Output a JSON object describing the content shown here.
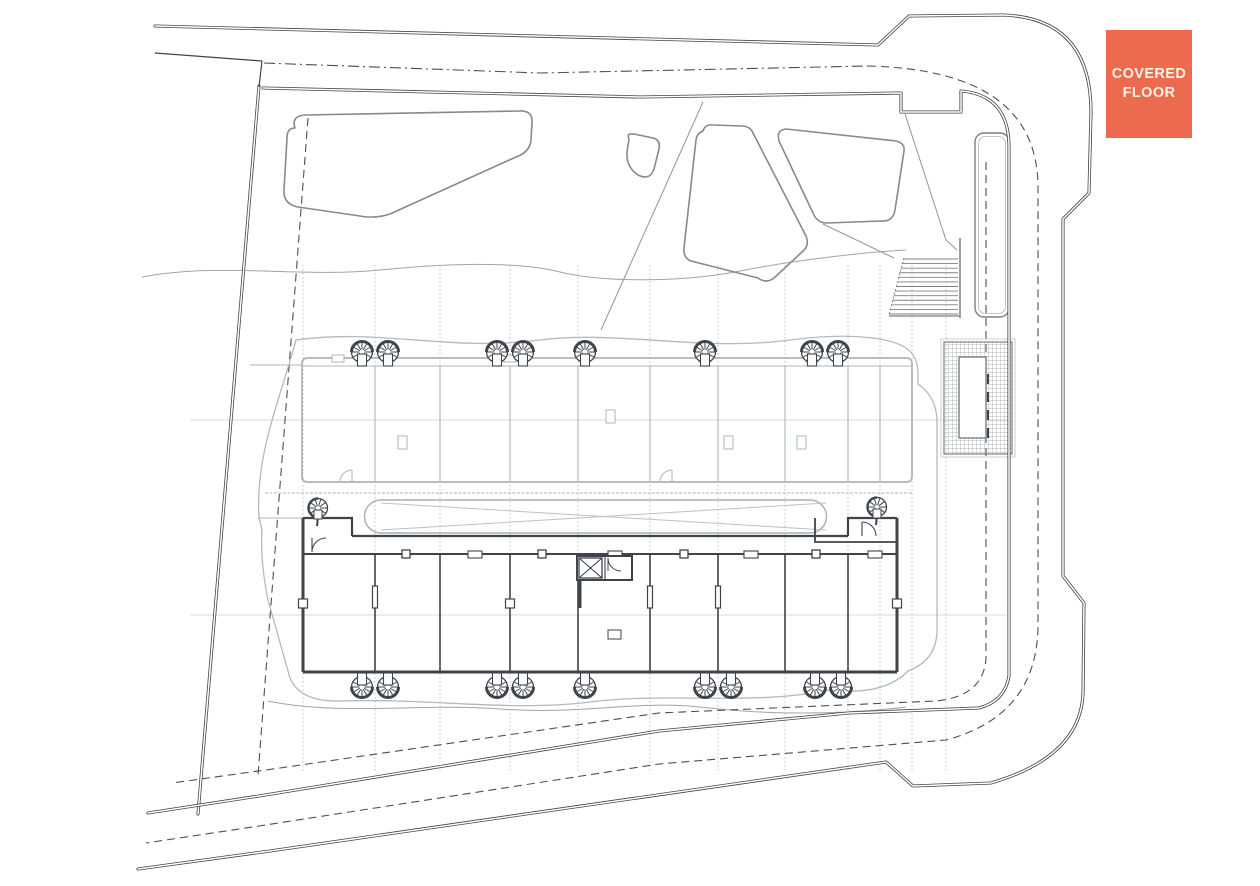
{
  "document": {
    "type": "architectural-site-plan",
    "floor_label": "Covered floor"
  },
  "badge": {
    "line1": "COVERED",
    "line2": "FLOOR",
    "bg": "#EC6A4E",
    "fg": "#FAF3E6"
  },
  "palette": {
    "paper": "#FFFFFF",
    "line_dark": "#3F444A",
    "line_mid": "#7A8187",
    "line_light": "#AEB4B9",
    "line_faint": "#C9CDD1",
    "dash": "#4A4F54",
    "hatch": "#989EA4"
  },
  "plan": {
    "grid": {
      "vertical_xs": [
        303,
        375,
        440,
        510,
        578,
        650,
        718,
        785,
        848,
        880,
        912,
        946
      ],
      "vertical_y1": 265,
      "vertical_y2": 772,
      "horizontal_ys": [
        420,
        615
      ],
      "horizontal_x1": 190,
      "horizontal_x2": 1006
    },
    "fans": {
      "radius": 10.5,
      "top_row": {
        "y": 352,
        "xs": [
          362,
          388,
          497,
          523,
          585,
          705,
          812,
          838
        ]
      },
      "bottom_row": {
        "y": 687,
        "xs": [
          362,
          388,
          497,
          523,
          585,
          705,
          731,
          815,
          841
        ]
      }
    },
    "spiral_stairs": [
      {
        "x": 318,
        "y": 508
      },
      {
        "x": 877,
        "y": 507
      }
    ],
    "stairs": {
      "x_right": 958,
      "y_top": 259,
      "y_bottom": 314,
      "treads": 13,
      "x_left_top": 903,
      "x_left_bottom": 889
    }
  }
}
